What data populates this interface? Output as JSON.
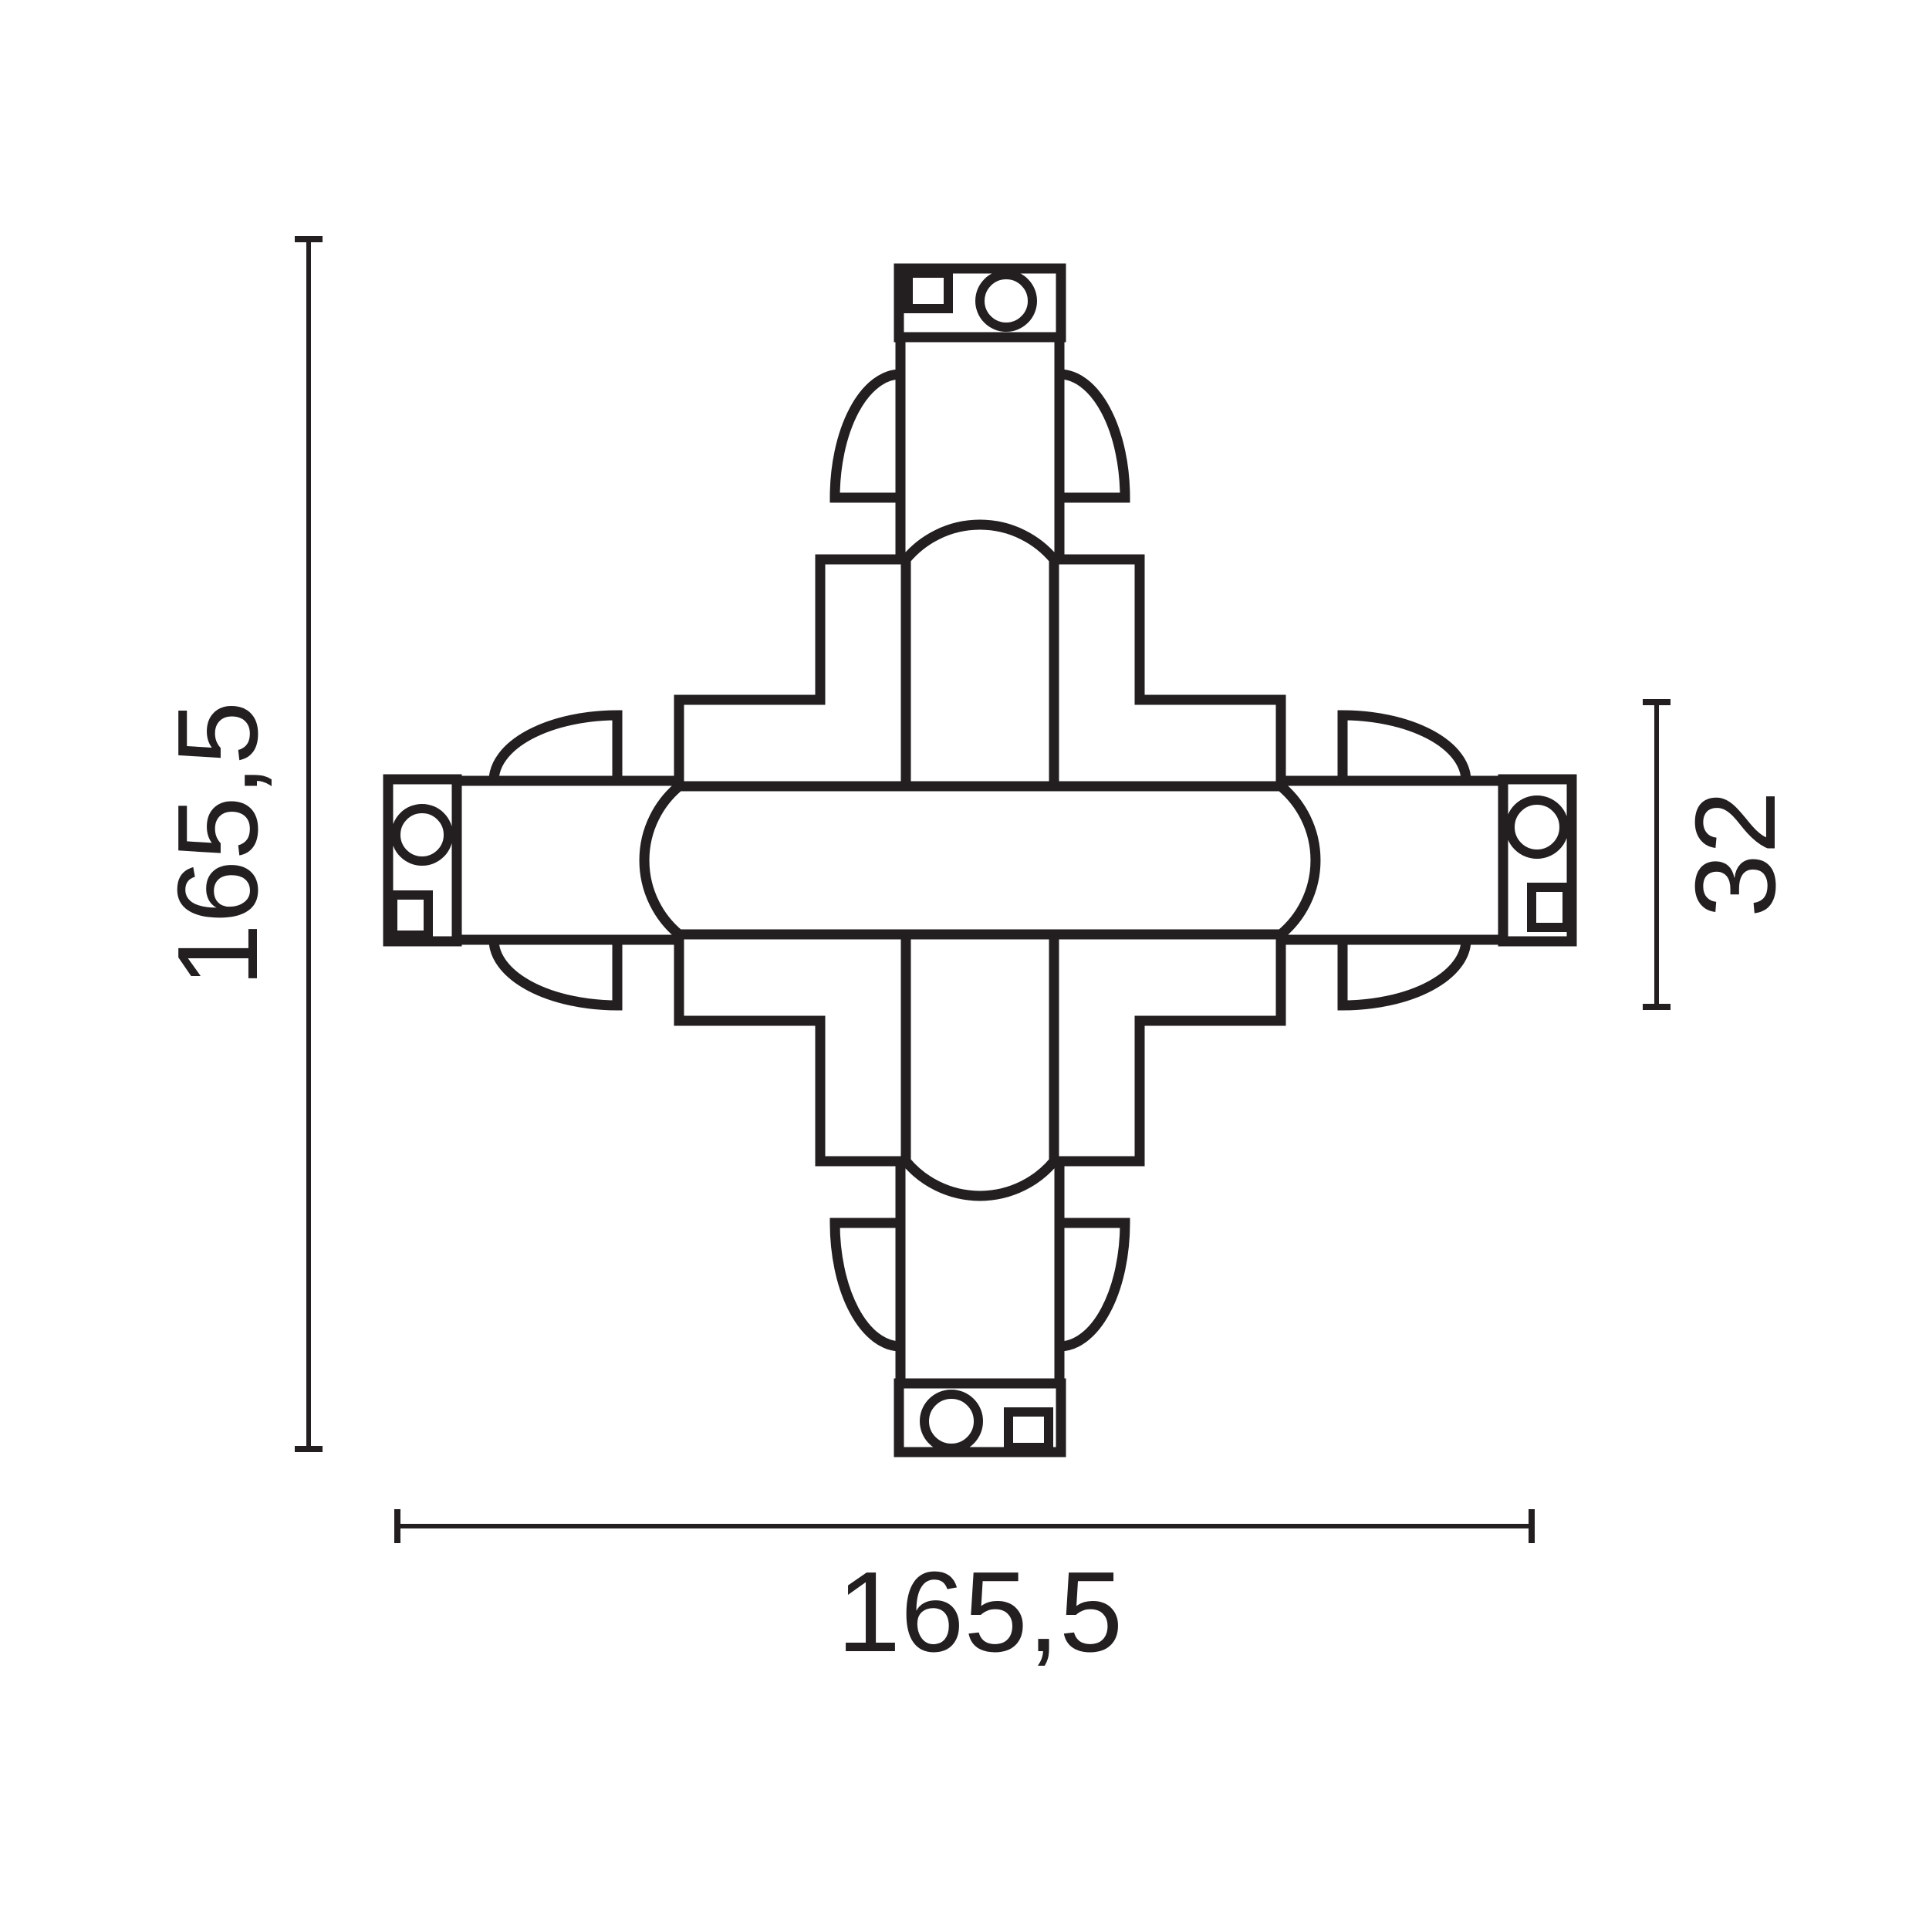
{
  "drawing": {
    "kind": "technical-dimension-drawing",
    "colors": {
      "line": "#231f20",
      "background": "#ffffff"
    },
    "dimensions": {
      "height_label": "165,5",
      "width_label": "165,5",
      "side_label": "32"
    }
  }
}
